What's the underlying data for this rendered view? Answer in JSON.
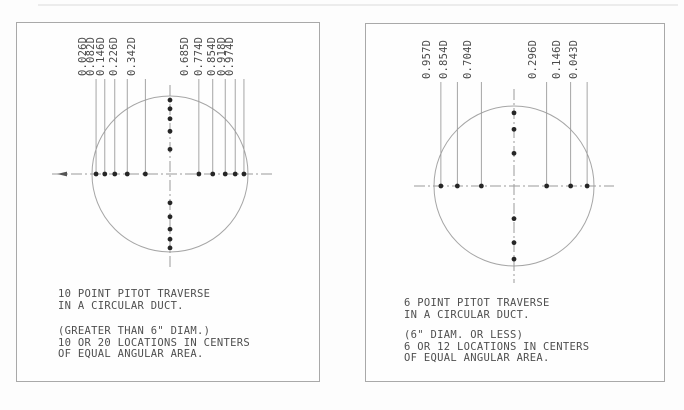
{
  "figure": {
    "title": "Pitot traverse locations in circular ducts",
    "panels": [
      {
        "name": "10-point",
        "labels": [
          {
            "text": "0.026D",
            "frac": 0.026
          },
          {
            "text": "0.082D",
            "frac": 0.082
          },
          {
            "text": "0.146D",
            "frac": 0.146
          },
          {
            "text": "0.226D",
            "frac": 0.226
          },
          {
            "text": "0.342D",
            "frac": 0.342
          },
          {
            "text": "0.685D",
            "frac": 0.685
          },
          {
            "text": "0.774D",
            "frac": 0.774
          },
          {
            "text": "0.854D",
            "frac": 0.854
          },
          {
            "text": "0.918D",
            "frac": 0.918
          },
          {
            "text": "0.974D",
            "frac": 0.974
          }
        ],
        "dot_fractions": [
          0.026,
          0.082,
          0.146,
          0.226,
          0.342,
          0.685,
          0.774,
          0.854,
          0.918,
          0.974
        ],
        "caption": [
          "10 POINT PITOT TRAVERSE",
          "IN A CIRCULAR DUCT."
        ],
        "note": [
          "(GREATER THAN 6\" DIAM.)",
          "10 OR 20 LOCATIONS IN CENTERS",
          "OF EQUAL ANGULAR AREA."
        ]
      },
      {
        "name": "6-point",
        "labels": [
          {
            "text": "0.957D",
            "frac": 0.043
          },
          {
            "text": "0.854D",
            "frac": 0.146
          },
          {
            "text": "0.704D",
            "frac": 0.296
          },
          {
            "text": "0.296D",
            "frac": 0.704
          },
          {
            "text": "0.146D",
            "frac": 0.854
          },
          {
            "text": "0.043D",
            "frac": 0.957
          }
        ],
        "dot_fractions": [
          0.043,
          0.146,
          0.296,
          0.704,
          0.854,
          0.957
        ],
        "caption": [
          "6 POINT PITOT TRAVERSE",
          "IN A CIRCULAR DUCT."
        ],
        "note": [
          "(6\" DIAM. OR LESS)",
          "6 OR 12 LOCATIONS IN CENTERS",
          "OF EQUAL ANGULAR AREA."
        ]
      }
    ],
    "colors": {
      "line": "#9b9b9b",
      "circle": "#a5a5a5",
      "dot": "#262626",
      "text": "#4f4f4f",
      "border": "#a9a9a9"
    }
  }
}
